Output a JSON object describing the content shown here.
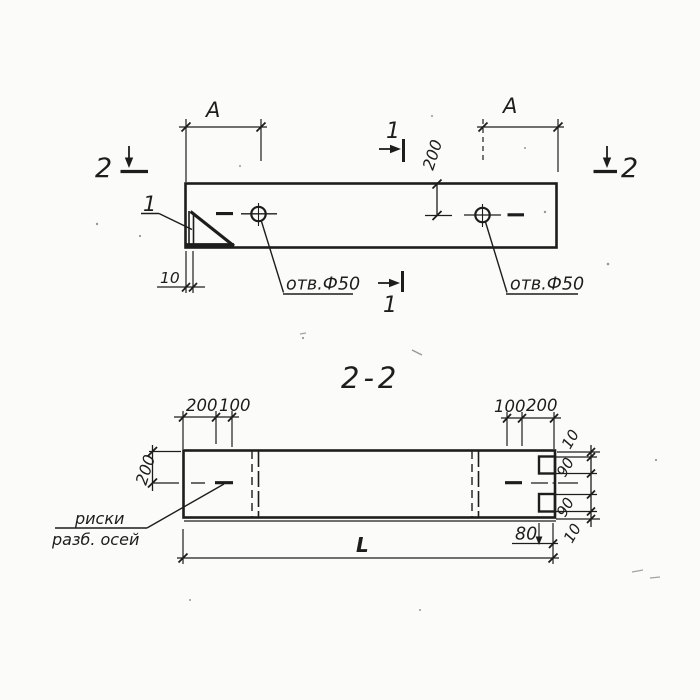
{
  "colors": {
    "ink": "#1d1d1d",
    "paper": "#fbfbf9"
  },
  "plan": {
    "dim_a_left": "A",
    "dim_a_right": "A",
    "dim_hole_offset": "200",
    "dim_corner_gap": "10",
    "detail_mark": "1",
    "section1_label": "1",
    "section2_label": "2",
    "hole_note_left": "отв.Ф50",
    "hole_note_right": "отв.Ф50"
  },
  "section": {
    "title": "2-2",
    "dims_top_left": [
      "200",
      "100"
    ],
    "dims_top_right": [
      "100",
      "200"
    ],
    "dim_axis_offset": "200",
    "dims_right": [
      "10",
      "90",
      "90",
      "10"
    ],
    "dim_notch_depth": "80",
    "dim_length": "L",
    "axes_note": [
      "риски",
      "разб. осей"
    ]
  }
}
